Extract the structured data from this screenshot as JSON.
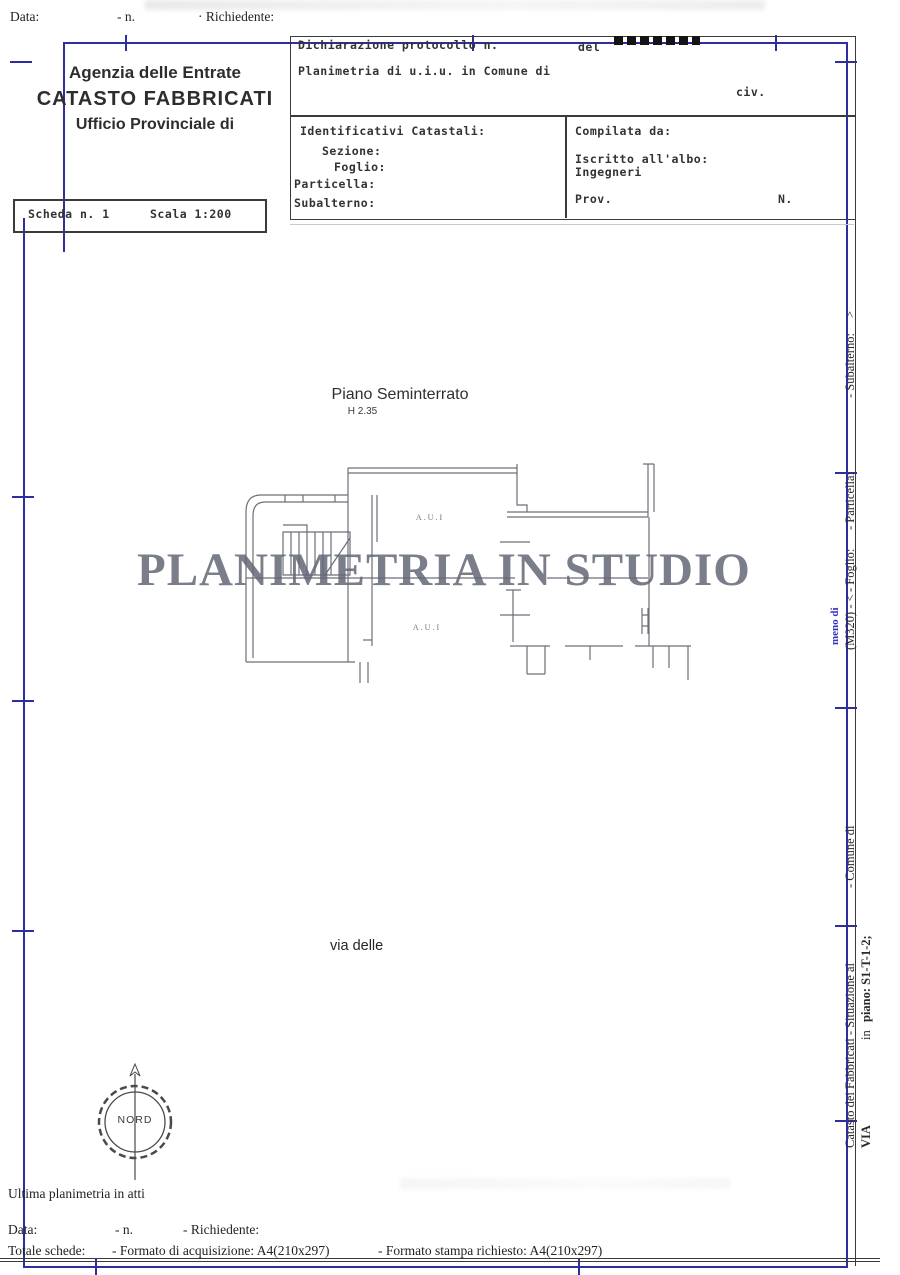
{
  "header_top": {
    "data": "Data:",
    "n": "- n.",
    "richiedente": "· Richiedente:"
  },
  "agency": {
    "line1": "Agenzia delle Entrate",
    "line2": "CATASTO FABBRICATI",
    "line3": "Ufficio Provinciale di"
  },
  "scheda": {
    "number": "Scheda n. 1",
    "scale": "Scala 1:200"
  },
  "declaration": {
    "protocol": "Dichiarazione protocollo n.",
    "del": "del",
    "planimetria": "Planimetria di u.i.u. in Comune di",
    "civ": "civ."
  },
  "catastali": {
    "title": "Identificativi Catastali:",
    "sezione": "Sezione:",
    "foglio": "Foglio:",
    "particella": "Particella:",
    "subalterno": "Subalterno:"
  },
  "compilata": {
    "title": "Compilata da:",
    "albo_line1": "Iscritto all'albo:",
    "albo_line2": "Ingegneri",
    "prov": "Prov.",
    "n": "N."
  },
  "plan": {
    "floor_title": "Piano Seminterrato",
    "floor_height": "H 2.35",
    "room_label_top": "A.U.I",
    "room_label_bottom": "A.U.I",
    "street": "via delle",
    "compass": "NORD"
  },
  "watermark": "PLANIMETRIA IN STUDIO",
  "sidebar": {
    "col1": [
      "Catasto dei Fabbricati - Situazione al",
      "- Comune di",
      "(M320) - <",
      "- Foglio:",
      "- Particella:",
      "- Subalterno:",
      ">"
    ],
    "blue_note": "meno di",
    "col2": [
      "VIA",
      "in",
      "piano: S1-T-1-2;"
    ]
  },
  "footer": {
    "ultima": "Ultima planimetria in atti",
    "data": "Data:",
    "n": "- n.",
    "richiedente": "- Richiedente:",
    "totale": "Totale schede:",
    "acquisizione": "- Formato di acquisizione: A4(210x297)",
    "stampa": "- Formato stampa richiesto: A4(210x297)"
  },
  "colors": {
    "frame_blue": "#2e2e9e",
    "plan_line": "#6e6e78",
    "watermark_gray": "#626776"
  }
}
